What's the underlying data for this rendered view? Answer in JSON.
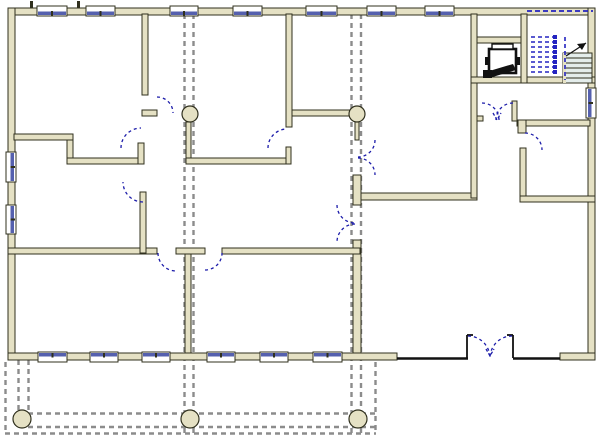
{
  "canvas": {
    "width": 600,
    "height": 439
  },
  "colors": {
    "background": "#ffffff",
    "wall_fill": "#e5e1c4",
    "wall_stroke": "#30301e",
    "glass": "#5560ae",
    "frame": "#ffffff",
    "door": "#1c1caa",
    "grid": "#8c8c8c",
    "stair_fill": "#e4edeb",
    "stair_line": "#30301e",
    "stair_dash": "#2323c0",
    "dark": "#111111"
  },
  "walls": [
    [
      8,
      8,
      587,
      7
    ],
    [
      8,
      8,
      7,
      352
    ],
    [
      588,
      8,
      7,
      352
    ],
    [
      8,
      353,
      389,
      7
    ],
    [
      560,
      353,
      35,
      7
    ],
    [
      142,
      14,
      6,
      81
    ],
    [
      142,
      110,
      15,
      6
    ],
    [
      186,
      122,
      5,
      38
    ],
    [
      186,
      158,
      105,
      6
    ],
    [
      286,
      147,
      5,
      17
    ],
    [
      286,
      14,
      6,
      113
    ],
    [
      292,
      110,
      58,
      6
    ],
    [
      355,
      122,
      4,
      18
    ],
    [
      353,
      175,
      8,
      30
    ],
    [
      353,
      240,
      8,
      113
    ],
    [
      8,
      248,
      149,
      6
    ],
    [
      176,
      248,
      29,
      6
    ],
    [
      222,
      248,
      138,
      6
    ],
    [
      185,
      254,
      6,
      99
    ],
    [
      14,
      134,
      59,
      6
    ],
    [
      67,
      140,
      6,
      18
    ],
    [
      67,
      158,
      71,
      6
    ],
    [
      138,
      143,
      6,
      21
    ],
    [
      140,
      192,
      6,
      61
    ],
    [
      361,
      193,
      116,
      7
    ],
    [
      471,
      14,
      6,
      184
    ],
    [
      477,
      116,
      6,
      5
    ],
    [
      477,
      37,
      50,
      6
    ],
    [
      471,
      77,
      56,
      6
    ],
    [
      521,
      14,
      6,
      69
    ],
    [
      512,
      101,
      5,
      20
    ],
    [
      517,
      120,
      73,
      6
    ],
    [
      518,
      120,
      8,
      13
    ],
    [
      520,
      148,
      6,
      54
    ],
    [
      520,
      196,
      75,
      6
    ],
    [
      527,
      77,
      68,
      6
    ]
  ],
  "windows": [
    {
      "side": "top",
      "x": 37,
      "len": 30
    },
    {
      "side": "top",
      "x": 86,
      "len": 29
    },
    {
      "side": "top",
      "x": 170,
      "len": 28
    },
    {
      "side": "top",
      "x": 233,
      "len": 29
    },
    {
      "side": "top",
      "x": 306,
      "len": 31
    },
    {
      "side": "top",
      "x": 367,
      "len": 29
    },
    {
      "side": "top",
      "x": 425,
      "len": 29
    },
    {
      "side": "bottom",
      "x": 38,
      "len": 29
    },
    {
      "side": "bottom",
      "x": 90,
      "len": 28
    },
    {
      "side": "bottom",
      "x": 142,
      "len": 28
    },
    {
      "side": "bottom",
      "x": 207,
      "len": 28
    },
    {
      "side": "bottom",
      "x": 260,
      "len": 28
    },
    {
      "side": "bottom",
      "x": 313,
      "len": 29
    },
    {
      "side": "left",
      "y": 152,
      "len": 30
    },
    {
      "side": "left",
      "y": 205,
      "len": 29
    },
    {
      "side": "right",
      "y": 88,
      "len": 30
    }
  ],
  "doors": [
    {
      "sx": 157,
      "sy": 97,
      "r": 16,
      "ex": 173,
      "ey": 113,
      "sweep": 1
    },
    {
      "sx": 268,
      "sy": 148,
      "r": 19,
      "ex": 287,
      "ey": 129,
      "sweep": 1
    },
    {
      "sx": 375,
      "sy": 140,
      "r": 17,
      "ex": 358,
      "ey": 157,
      "sweep": 1
    },
    {
      "sx": 358,
      "sy": 158,
      "r": 17,
      "ex": 375,
      "ey": 175,
      "sweep": 1
    },
    {
      "sx": 337,
      "sy": 205,
      "r": 18,
      "ex": 355,
      "ey": 223,
      "sweep": 0
    },
    {
      "sx": 355,
      "sy": 224,
      "r": 18,
      "ex": 337,
      "ey": 242,
      "sweep": 0
    },
    {
      "sx": 121,
      "sy": 148,
      "r": 20,
      "ex": 141,
      "ey": 128,
      "sweep": 1
    },
    {
      "sx": 143,
      "sy": 202,
      "r": 20,
      "ex": 123,
      "ey": 182,
      "sweep": 1
    },
    {
      "sx": 158,
      "sy": 253,
      "r": 18,
      "ex": 176,
      "ey": 271,
      "sweep": 0
    },
    {
      "sx": 205,
      "sy": 270,
      "r": 17,
      "ex": 222,
      "ey": 253,
      "sweep": 0
    },
    {
      "sx": 525,
      "sy": 133,
      "r": 17,
      "ex": 542,
      "ey": 150,
      "sweep": 1
    },
    {
      "sx": 482,
      "sy": 103,
      "r": 17,
      "ex": 499,
      "ey": 120,
      "sweep": 1
    },
    {
      "sx": 513,
      "sy": 103,
      "r": 17,
      "ex": 496,
      "ey": 120,
      "sweep": 0
    },
    {
      "sx": 468,
      "sy": 336,
      "r": 22,
      "ex": 490,
      "ey": 358,
      "sweep": 1
    },
    {
      "sx": 512,
      "sy": 336,
      "r": 22,
      "ex": 490,
      "ey": 358,
      "sweep": 0
    }
  ],
  "door_marks": [
    [
      [
        493,
        113
      ],
      [
        497,
        120
      ],
      [
        501,
        113
      ]
    ],
    [
      [
        486,
        349
      ],
      [
        490,
        356
      ],
      [
        494,
        349
      ]
    ]
  ],
  "columns": [
    {
      "cx": 190,
      "cy": 114,
      "r": 8
    },
    {
      "cx": 357,
      "cy": 114,
      "r": 8
    },
    {
      "cx": 22,
      "cy": 419,
      "r": 9
    },
    {
      "cx": 190,
      "cy": 419,
      "r": 9
    },
    {
      "cx": 358,
      "cy": 419,
      "r": 9
    }
  ],
  "gridlines": [
    [
      184.5,
      14,
      184.5,
      437
    ],
    [
      193.5,
      14,
      193.5,
      437
    ],
    [
      351.5,
      14,
      351.5,
      437
    ],
    [
      361,
      14,
      361,
      437
    ],
    [
      18.5,
      360,
      18.5,
      414
    ],
    [
      28.5,
      360,
      28.5,
      414
    ]
  ],
  "canopy_lines": [
    [
      5.5,
      362,
      5.5,
      433
    ],
    [
      375.5,
      362,
      375.5,
      433
    ],
    [
      5,
      433.5,
      376,
      433.5
    ],
    [
      28,
      413.5,
      375,
      413.5
    ],
    [
      28,
      427,
      375,
      427
    ]
  ],
  "thin_lines": [
    [
      397,
      358.5,
      468,
      358.5,
      2.4
    ],
    [
      513,
      358.5,
      560,
      358.5,
      2.4
    ],
    [
      467,
      335,
      467,
      358,
      1.8
    ],
    [
      513,
      335,
      513,
      358,
      1.8
    ],
    [
      467,
      335,
      473,
      335,
      1.8
    ],
    [
      507,
      335,
      513,
      335,
      1.8
    ]
  ],
  "ticks": [
    [
      30,
      1,
      3,
      7
    ],
    [
      77,
      1,
      3,
      7
    ]
  ],
  "stair": {
    "treads": {
      "x": 563,
      "y": 53,
      "w": 29,
      "h": 30,
      "step": 5
    },
    "dash_rows": {
      "x1": 531,
      "x2": 558,
      "ys": [
        37,
        42,
        47,
        52,
        57,
        62,
        67,
        72
      ]
    },
    "squares": {
      "x": 553,
      "size": 4
    },
    "top_dash": [
      527,
      11,
      593,
      11
    ],
    "vert_dash": [
      565,
      37,
      565,
      80
    ],
    "arrow_line": [
      566,
      56,
      586,
      43
    ],
    "arrow_head": [
      [
        586,
        43
      ],
      [
        577,
        44
      ],
      [
        582,
        50
      ]
    ]
  },
  "elevator": {
    "car": [
      489,
      49,
      27,
      24
    ],
    "bar": [
      492,
      44,
      21,
      5
    ],
    "brackets": [
      [
        485,
        57,
        4,
        8
      ],
      [
        516,
        57,
        4,
        8
      ]
    ],
    "piston": [
      [
        486,
        72
      ],
      [
        513,
        64
      ],
      [
        516,
        70
      ],
      [
        489,
        78
      ]
    ],
    "piston_base": [
      483,
      70,
      9,
      8
    ]
  }
}
